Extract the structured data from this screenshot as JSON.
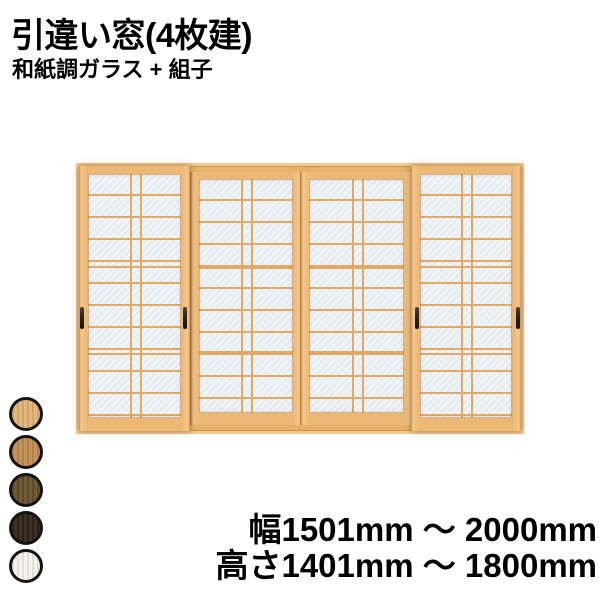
{
  "header": {
    "title": "引違い窓(4枚建)",
    "subtitle": "和紙調ガラス + 組子"
  },
  "specs": {
    "width_range": "幅1501mm ～ 2000mm",
    "height_range": "高さ1401mm ～ 1800mm"
  },
  "swatches": [
    {
      "name": "light-wood",
      "color": "#dfb074"
    },
    {
      "name": "medium-wood",
      "color": "#bd8a4d"
    },
    {
      "name": "dark-olive-wood",
      "color": "#5f4b27"
    },
    {
      "name": "dark-brown",
      "color": "#281f14"
    },
    {
      "name": "white",
      "color": "#f5f2ec"
    }
  ],
  "window_illustration": {
    "panel_count": 4,
    "colors": {
      "frame": "#ecb873",
      "frame_edge": "#cd8f4a",
      "frame_highlight": "#f3c88e",
      "kumiko": "#e2a963",
      "glass": "#e8edf2",
      "handle": "#2b2722",
      "sill": "#e7b269"
    }
  }
}
